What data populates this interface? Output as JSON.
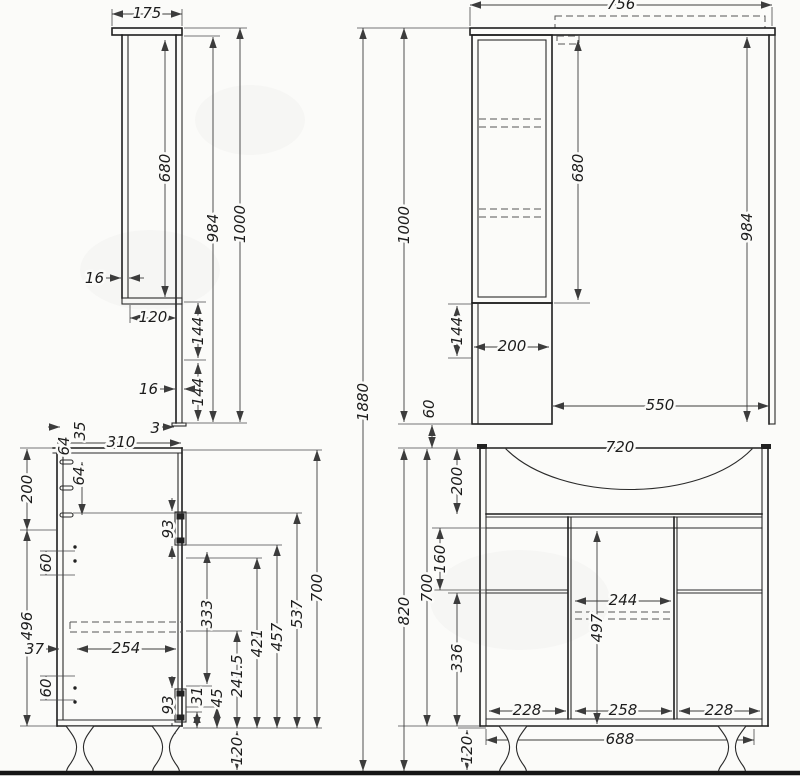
{
  "drawing_title": "bathroom vanity and mirror cabinet dimensional drawing",
  "colors": {
    "background": "#fbfbf9",
    "outline": "#1e1e1e",
    "dimension_line": "#3c3c3c",
    "ground_line": "#161616"
  },
  "views": {
    "mirror_side": {
      "label": "mirror cabinet side view",
      "dims": {
        "width": "175",
        "mirror_height": "680",
        "back_height": "984",
        "total_height": "1000",
        "panel_top": "16",
        "shelf_depth": "120",
        "offset_upper": "144",
        "offset_lower": "144",
        "panel_back": "16",
        "bottom_gap": "3"
      }
    },
    "mirror_front": {
      "label": "mirror cabinet front view",
      "dims": {
        "total_width": "756",
        "total_height": "1000",
        "overall_height": "1880",
        "mirror_height": "680",
        "right_height": "984",
        "lower_offset": "144",
        "cabinet_width": "200",
        "mirror_width": "550",
        "gap": "60"
      }
    },
    "vanity_side": {
      "label": "vanity cabinet side view",
      "dims": {
        "depth": "310",
        "offset_35": "35",
        "offset_64": "64",
        "peg_spacing": "64",
        "top_section": "200",
        "hole_upper": "60",
        "side_height": "496",
        "hole_lower": "60",
        "rail_offset": "37",
        "rail_length": "254",
        "hinge_upper": "93",
        "hinge_lower": "93",
        "hinge_span": "333",
        "h31": "31",
        "h45": "45",
        "h241": "241.5",
        "h421": "421",
        "h457": "457",
        "h537": "537",
        "body_height": "700",
        "leg_height": "120"
      }
    },
    "vanity_front": {
      "label": "vanity cabinet front view",
      "dims": {
        "width": "720",
        "top_section": "200",
        "drawer": "160",
        "bottom_section": "336",
        "body_height": "700",
        "total_height": "820",
        "middle_width": "244",
        "middle_height": "497",
        "door_left": "228",
        "door_middle": "258",
        "door_right": "228",
        "base_width": "688",
        "leg_height": "120"
      }
    }
  }
}
